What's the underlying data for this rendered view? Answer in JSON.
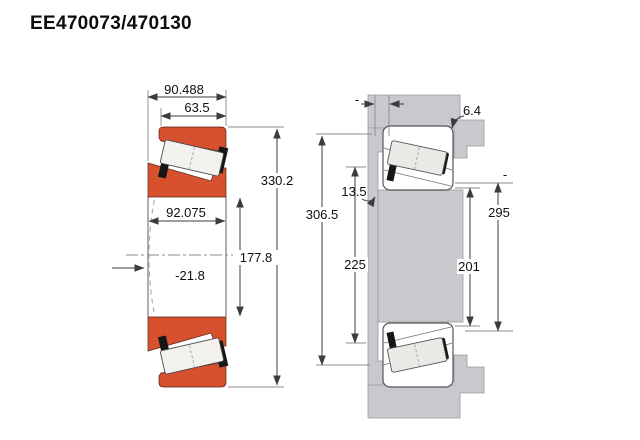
{
  "title": "EE470073/470130",
  "left": {
    "overall_width": "90.488",
    "cup_width": "63.5",
    "cone_width": "92.075",
    "outer_diameter": "330.2",
    "bore_diameter": "177.8",
    "effective_center": "-21.8"
  },
  "right": {
    "fillet_radius": "6.4",
    "rib_width": "13.5",
    "shoulder_diameter": "306.5",
    "shaft_shoulder_diameter": "225",
    "shaft_backing_diameter": "201",
    "housing_backing_diameter": "295",
    "unlabeled_top": "-",
    "unlabeled_side": "-"
  },
  "colors": {
    "ring": "#d7512f",
    "steel": "#c9c9cd",
    "line": "#3c3c3c"
  }
}
